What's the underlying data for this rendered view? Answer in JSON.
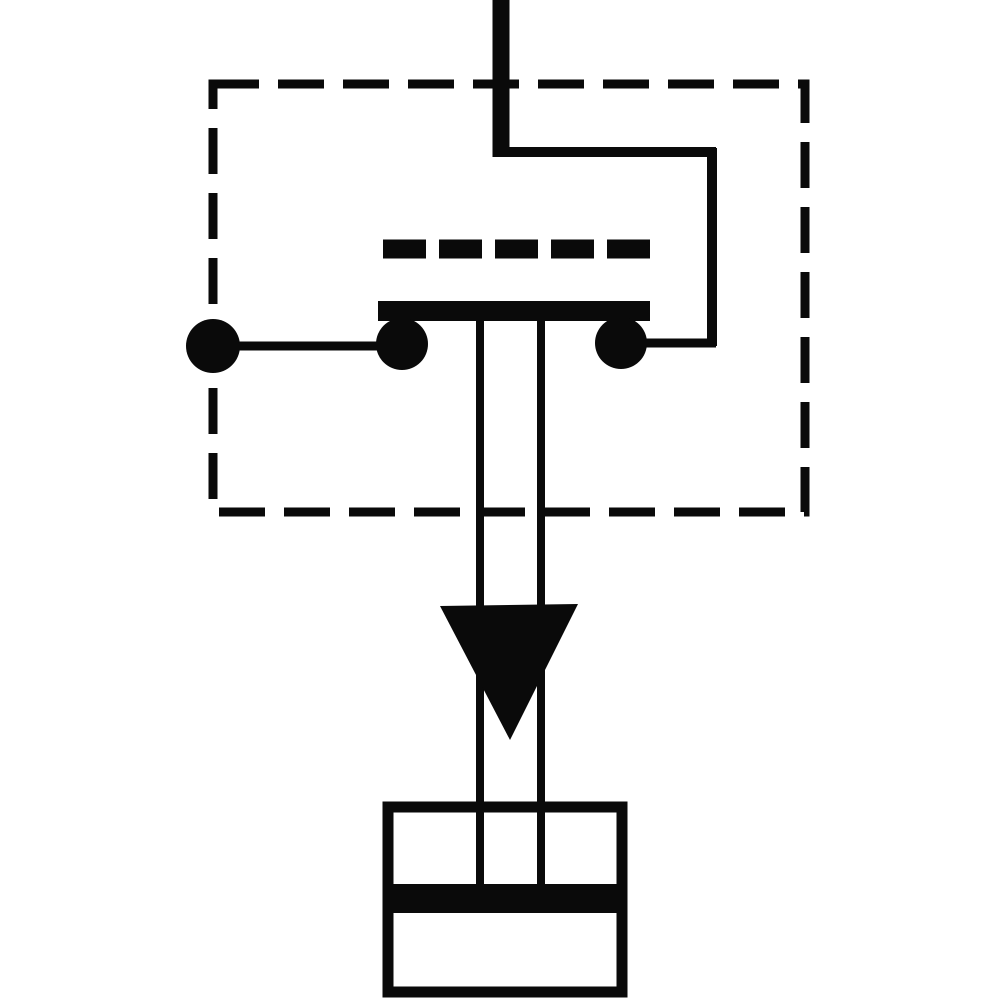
{
  "diagram": {
    "kind": "pressure-switch-circuit-schematic",
    "colors": {
      "ink": "#0a0a0a",
      "background": "#ffffff"
    },
    "canvas": {
      "width": 1000,
      "height": 1000
    },
    "shapes": [
      {
        "name": "supply-line-vertical",
        "type": "line",
        "x1": 501,
        "y1": 0,
        "x2": 501,
        "y2": 157,
        "w": 17
      },
      {
        "name": "supply-elbow-horizontal",
        "type": "line",
        "x1": 497,
        "y1": 152,
        "x2": 716,
        "y2": 152,
        "w": 10
      },
      {
        "name": "supply-drop-vertical",
        "type": "line",
        "x1": 712,
        "y1": 148,
        "x2": 712,
        "y2": 346,
        "w": 10
      },
      {
        "name": "enclosure-dashed-box",
        "type": "rect-dashed",
        "x": 213,
        "y": 84,
        "wd": 592,
        "ht": 428,
        "stroke": 9,
        "dash": "46 19"
      },
      {
        "name": "contact-gap-dashes",
        "type": "line-dashed",
        "x1": 383,
        "y1": 249,
        "x2": 652,
        "y2": 249,
        "w": 19,
        "dash": "43 13"
      },
      {
        "name": "contact-bridge-bar",
        "type": "rect-filled",
        "x": 378,
        "y": 301,
        "wd": 272,
        "ht": 20
      },
      {
        "name": "contact-dot-left",
        "type": "circle",
        "cx": 402,
        "cy": 344,
        "r": 26
      },
      {
        "name": "contact-dot-right",
        "type": "circle",
        "cx": 621,
        "cy": 343,
        "r": 26
      },
      {
        "name": "terminal-dot",
        "type": "circle",
        "cx": 213,
        "cy": 346,
        "r": 27
      },
      {
        "name": "terminal-wire-horizontal",
        "type": "line",
        "x1": 213,
        "y1": 346,
        "x2": 402,
        "y2": 346,
        "w": 9
      },
      {
        "name": "contact-wire-right",
        "type": "line",
        "x1": 621,
        "y1": 343,
        "x2": 716,
        "y2": 343,
        "w": 9
      },
      {
        "name": "plunger-rod-left",
        "type": "line",
        "x1": 480,
        "y1": 318,
        "x2": 480,
        "y2": 890,
        "w": 8
      },
      {
        "name": "plunger-rod-right",
        "type": "line",
        "x1": 541,
        "y1": 318,
        "x2": 541,
        "y2": 890,
        "w": 8
      },
      {
        "name": "pressure-arrowhead",
        "type": "polygon",
        "points": "440,606 578,604 510,740"
      },
      {
        "name": "cylinder-body",
        "type": "rect-stroked",
        "x": 388,
        "y": 807,
        "wd": 234,
        "ht": 185,
        "stroke": 11
      },
      {
        "name": "piston-band",
        "type": "rect-filled",
        "x": 387,
        "y": 884,
        "wd": 237,
        "ht": 29
      }
    ]
  }
}
